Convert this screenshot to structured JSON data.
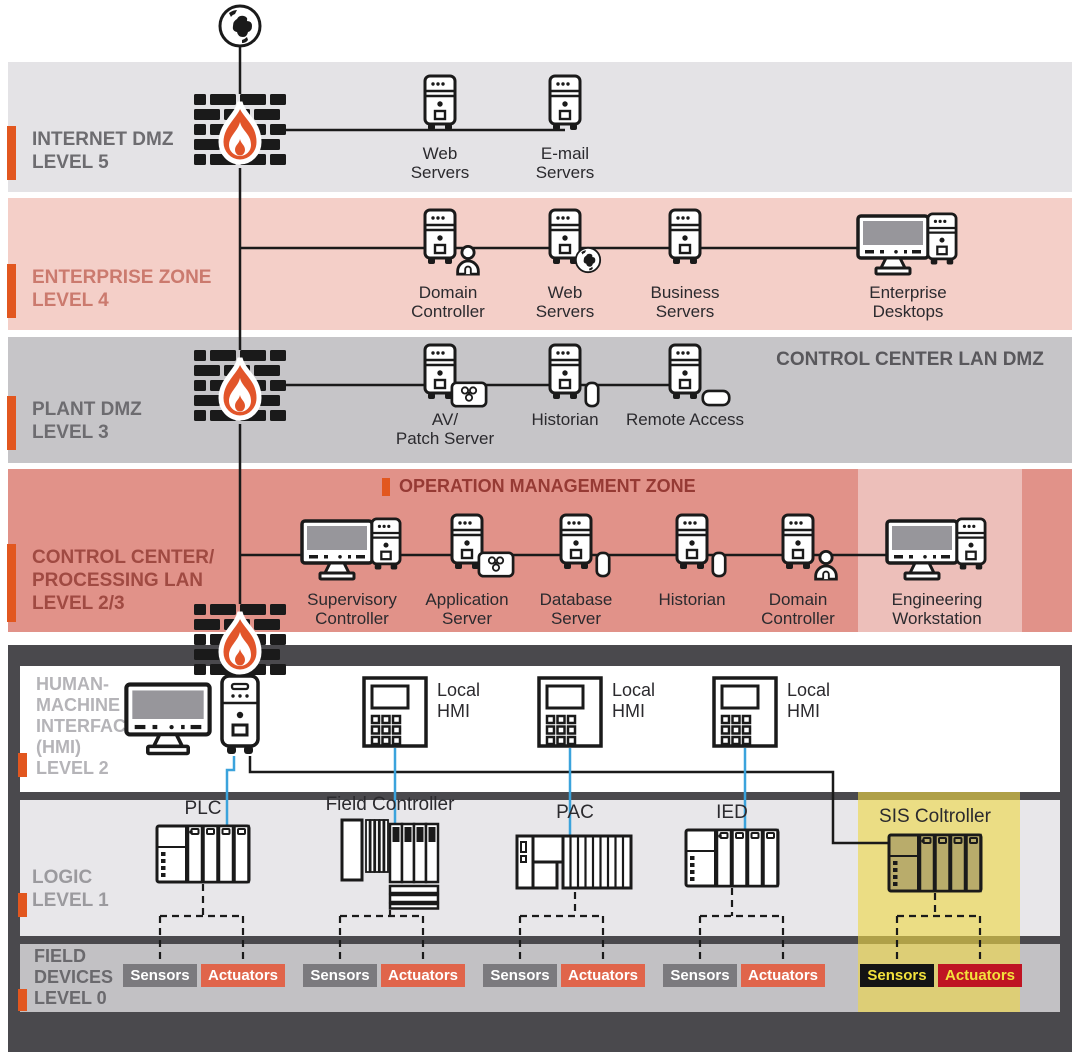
{
  "colors": {
    "accent_orange": "#e2571f",
    "flame_orange": "#e2552a",
    "connector_blue": "#3ba3dc",
    "sensor_badge_bg": "#7b7a7e",
    "actuator_badge_bg": "#e0654b",
    "sis_sensor_bg": "#141414",
    "sis_actuator_bg": "#bf1423",
    "sis_badge_text": "#f3e13c",
    "zone_l5_bg": "#e4e3e6",
    "zone_l4_bg": "#f4cfc8",
    "zone_l3_bg": "#c6c5c8",
    "zone_l23_bg": "#e19289",
    "ot_frame": "#4a494d",
    "hmi_bg": "#ffffff",
    "logic_bg": "#e8e7ea",
    "field_bg": "#c2c1c4",
    "sis_column": "#ede28b",
    "eng_column": "#ecc8c1"
  },
  "zones": {
    "internet_dmz": {
      "label": "INTERNET DMZ\nLEVEL 5",
      "devices": {
        "web": "Web\nServers",
        "email": "E-mail\nServers"
      }
    },
    "enterprise": {
      "label": "ENTERPRISE ZONE\nLEVEL 4",
      "devices": {
        "domain": "Domain\nController",
        "web": "Web\nServers",
        "business": "Business\nServers",
        "desktops": "Enterprise\nDesktops"
      }
    },
    "plant_dmz": {
      "label": "PLANT DMZ\nLEVEL 3",
      "corner": "CONTROL CENTER LAN DMZ",
      "devices": {
        "av": "AV/\nPatch Server",
        "historian": "Historian",
        "remote": "Remote Access"
      }
    },
    "control_center": {
      "label": "CONTROL CENTER/\nPROCESSING LAN\nLEVEL 2/3",
      "title": "OPERATION MANAGEMENT ZONE",
      "devices": {
        "supervisory": "Supervisory\nController",
        "application": "Application\nServer",
        "database": "Database\nServer",
        "historian": "Historian",
        "domain": "Domain\nController",
        "engineering": "Engineering\nWorkstation"
      }
    },
    "hmi": {
      "label": "HUMAN-\nMACHINE\nINTERFACES\n(HMI)\nLEVEL 2",
      "devices": {
        "hmi1": "Local\nHMI",
        "hmi2": "Local\nHMI",
        "hmi3": "Local\nHMI"
      }
    },
    "logic": {
      "label": "LOGIC\nLEVEL 1",
      "devices": {
        "plc": "PLC",
        "field_controller": "Field Controller",
        "pac": "PAC",
        "ied": "IED",
        "sis": "SIS Coltroller"
      }
    },
    "field": {
      "label": "FIELD\nDEVICES\nLEVEL 0",
      "pairs": [
        {
          "sensors": "Sensors",
          "actuators": "Actuators"
        },
        {
          "sensors": "Sensors",
          "actuators": "Actuators"
        },
        {
          "sensors": "Sensors",
          "actuators": "Actuators"
        },
        {
          "sensors": "Sensors",
          "actuators": "Actuators"
        },
        {
          "sensors": "Sensors",
          "actuators": "Actuators"
        }
      ]
    }
  }
}
